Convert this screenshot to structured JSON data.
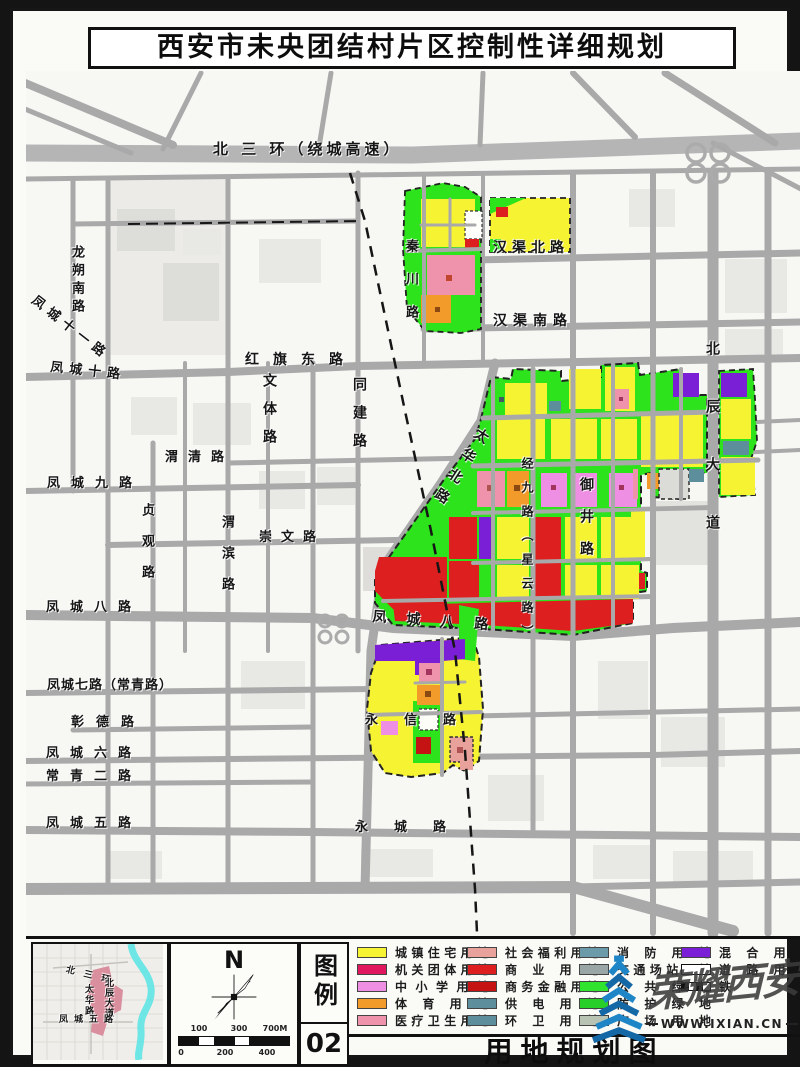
{
  "title": "西安市未央团结村片区控制性详细规划",
  "footer": {
    "title": "用地规划图"
  },
  "legend_box": {
    "title": "图例",
    "number": "02"
  },
  "compass": {
    "label": "N"
  },
  "scale_bar": {
    "top": [
      "100",
      "300",
      "700M"
    ],
    "bottom": [
      "0",
      "200",
      "400"
    ]
  },
  "watermark": {
    "name": "荣耀西安",
    "url": "WWW.IXIAN.CN"
  },
  "colors": {
    "residential_yellow": "#f6f332",
    "agency_crimson": "#e0175e",
    "school_pink": "#ef8fe3",
    "sports_orange": "#f29b2a",
    "medical_pink": "#ef93ad",
    "welfare_salmon": "#e8a29b",
    "commercial_red": "#dd1f1f",
    "finance_darkred": "#c51212",
    "utility_teal": "#5d8e9c",
    "fire_teal": "#6b9aa8",
    "transport_gray": "#9aa5a5",
    "green_public": "#2fe32f",
    "green_buffer": "#28cf28",
    "plaza_gray": "#b9c3b4",
    "mixed_purple": "#7a1fd6",
    "road_gray": "#a9a9a9",
    "river_cyan": "#5ee4e4",
    "logo_blue": "#1e86c6"
  },
  "legend": {
    "columns": [
      [
        {
          "label": "城镇住宅用地",
          "color": "#f6f332"
        },
        {
          "label": "机关团体用地",
          "color": "#e0175e"
        },
        {
          "label": "中小学用地",
          "color": "#ef8fe3"
        },
        {
          "label": "体育用地",
          "color": "#f29b2a"
        },
        {
          "label": "医疗卫生用地",
          "color": "#ef93ad"
        }
      ],
      [
        {
          "label": "社会福利用地",
          "color": "#e8a29b"
        },
        {
          "label": "商业用地",
          "color": "#dd1f1f"
        },
        {
          "label": "商务金融用地",
          "color": "#c51212"
        },
        {
          "label": "供电用地",
          "color": "#5d8e9c"
        },
        {
          "label": "环卫用地",
          "color": "#5d8e9c"
        }
      ],
      [
        {
          "label": "消防用地",
          "color": "#6b9aa8"
        },
        {
          "label": "交通场站用地",
          "color": "#9aa5a5"
        },
        {
          "label": "公共绿地",
          "color": "#2fe32f"
        },
        {
          "label": "防护绿地",
          "color": "#28cf28"
        },
        {
          "label": "广场用地",
          "color": "#b9c3b4"
        }
      ],
      [
        {
          "label": "混合用地",
          "color": "#7a1fd6"
        },
        {
          "label": "道路用地",
          "color": "#ffffff",
          "type": "road"
        },
        {
          "label": "铁路",
          "color": "#111111",
          "type": "rail"
        }
      ]
    ]
  },
  "map": {
    "labels": [
      {
        "t": "北 三 环（绕城高速）",
        "x": 200,
        "y": 131,
        "ls": 4,
        "fs": 15
      },
      {
        "t": "龙朔南路",
        "x": 57,
        "y": 234,
        "v": 1,
        "ls": 5,
        "fs": 13
      },
      {
        "t": "凤城十一路",
        "x": 24,
        "y": 283,
        "r": 38,
        "ls": 6,
        "fs": 13
      },
      {
        "t": "凤城十路",
        "x": 38,
        "y": 350,
        "r": 6,
        "ls": 6,
        "fs": 13
      },
      {
        "t": "红旗东路",
        "x": 232,
        "y": 342,
        "ls": 14,
        "fs": 14
      },
      {
        "t": "文体路",
        "x": 249,
        "y": 362,
        "v": 1,
        "ls": 14,
        "fs": 14
      },
      {
        "t": "同建路",
        "x": 339,
        "y": 366,
        "v": 1,
        "ls": 14,
        "fs": 14
      },
      {
        "t": "渭清路",
        "x": 152,
        "y": 440,
        "ls": 10,
        "fs": 13
      },
      {
        "t": "凤城九路",
        "x": 34,
        "y": 466,
        "ls": 11,
        "fs": 13
      },
      {
        "t": "贞观路",
        "x": 127,
        "y": 492,
        "v": 1,
        "ls": 18,
        "fs": 13
      },
      {
        "t": "渭滨路",
        "x": 207,
        "y": 504,
        "v": 1,
        "ls": 18,
        "fs": 13
      },
      {
        "t": "崇文路",
        "x": 246,
        "y": 520,
        "ls": 9,
        "fs": 13
      },
      {
        "t": "凤城八路",
        "x": 33,
        "y": 590,
        "ls": 11,
        "fs": 13
      },
      {
        "t": "凤城八路",
        "x": 360,
        "y": 599,
        "r": 4,
        "ls": 20,
        "fs": 14
      },
      {
        "t": "凤城七路（常青路）",
        "x": 34,
        "y": 668,
        "ls": 1,
        "fs": 13
      },
      {
        "t": "彰德路",
        "x": 58,
        "y": 705,
        "ls": 12,
        "fs": 13
      },
      {
        "t": "凤城六路",
        "x": 33,
        "y": 736,
        "ls": 11,
        "fs": 13
      },
      {
        "t": "常青二路",
        "x": 33,
        "y": 759,
        "ls": 11,
        "fs": 13
      },
      {
        "t": "凤城五路",
        "x": 33,
        "y": 806,
        "ls": 11,
        "fs": 13
      },
      {
        "t": "永城路",
        "x": 342,
        "y": 810,
        "ls": 26,
        "fs": 13
      },
      {
        "t": "秦川路",
        "x": 391,
        "y": 228,
        "v": 1,
        "ls": 20,
        "fs": 13
      },
      {
        "t": "汉渠北路",
        "x": 480,
        "y": 230,
        "ls": 5,
        "fs": 14
      },
      {
        "t": "汉渠南路",
        "x": 480,
        "y": 303,
        "ls": 6,
        "fs": 14
      },
      {
        "t": "北辰大道",
        "x": 692,
        "y": 330,
        "v": 1,
        "ls": 44,
        "fs": 14
      },
      {
        "t": "太华北路",
        "x": 466,
        "y": 414,
        "v": 1,
        "r": 33,
        "ls": 10,
        "fs": 14
      },
      {
        "t": "经九路（星云路）",
        "x": 508,
        "y": 446,
        "v": 1,
        "ls": 12,
        "fs": 12
      },
      {
        "t": "御井路",
        "x": 566,
        "y": 466,
        "v": 1,
        "ls": 18,
        "fs": 14
      },
      {
        "t": "永信路",
        "x": 352,
        "y": 703,
        "ls": 26,
        "fs": 13
      }
    ]
  },
  "inset_map": {
    "labels": [
      {
        "t": "北 三 环",
        "x": 34,
        "y": 22,
        "r": 14,
        "ls": 3,
        "fs": 9
      },
      {
        "t": "太华路",
        "x": 50,
        "y": 40,
        "v": 1,
        "ls": 2,
        "fs": 9
      },
      {
        "t": "北辰大道",
        "x": 70,
        "y": 34,
        "v": 1,
        "ls": 1,
        "fs": 9
      },
      {
        "t": "凤城五路",
        "x": 26,
        "y": 72,
        "ls": 6,
        "fs": 9
      }
    ]
  }
}
